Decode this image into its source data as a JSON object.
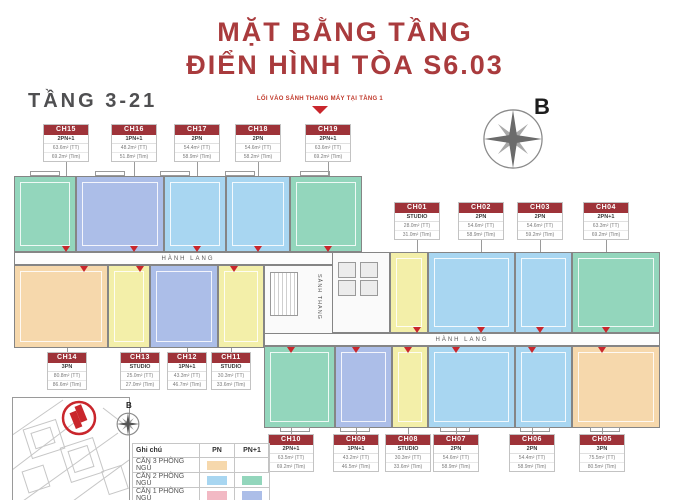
{
  "header": {
    "title_line1": "MẶT BẰNG TẦNG",
    "title_line2": "ĐIỂN HÌNH TÒA S6.03",
    "floor_range": "TẦNG 3-21",
    "entry_note": "LỐI VÀO SẢNH THANG MÁY TẠI TẦNG 1",
    "compass_label": "B"
  },
  "plan": {
    "corridor_left_label": "HÀNH LANG",
    "corridor_right_label": "HÀNH LANG",
    "stair_lobby_label": "SẢNH THANG"
  },
  "units": [
    {
      "id": "CH15",
      "type": "2PN+1",
      "area_tt": "63.6m² (TT)",
      "area_tim": "69.2m² (Tim)",
      "color": "#93D6BC"
    },
    {
      "id": "CH16",
      "type": "1PN+1",
      "area_tt": "48.2m² (TT)",
      "area_tim": "51.8m² (Tim)",
      "color": "#ACBEE8"
    },
    {
      "id": "CH17",
      "type": "2PN",
      "area_tt": "54.4m² (TT)",
      "area_tim": "58.9m² (Tim)",
      "color": "#A8D6F1"
    },
    {
      "id": "CH18",
      "type": "2PN",
      "area_tt": "54.6m² (TT)",
      "area_tim": "58.2m² (Tim)",
      "color": "#A8D6F1"
    },
    {
      "id": "CH19",
      "type": "2PN+1",
      "area_tt": "63.6m² (TT)",
      "area_tim": "69.2m² (Tim)",
      "color": "#93D6BC"
    },
    {
      "id": "CH01",
      "type": "STUDIO",
      "area_tt": "28.0m² (TT)",
      "area_tim": "31.0m² (Tim)",
      "color": "#F3EFA9"
    },
    {
      "id": "CH02",
      "type": "2PN",
      "area_tt": "54.6m² (TT)",
      "area_tim": "58.9m² (Tim)",
      "color": "#A8D6F1"
    },
    {
      "id": "CH03",
      "type": "2PN",
      "area_tt": "54.6m² (TT)",
      "area_tim": "59.2m² (Tim)",
      "color": "#A8D6F1"
    },
    {
      "id": "CH04",
      "type": "2PN+1",
      "area_tt": "63.3m² (TT)",
      "area_tim": "69.2m² (Tim)",
      "color": "#93D6BC"
    },
    {
      "id": "CH14",
      "type": "3PN",
      "area_tt": "80.8m² (TT)",
      "area_tim": "86.6m² (Tim)",
      "color": "#F6D8AC"
    },
    {
      "id": "CH13",
      "type": "STUDIO",
      "area_tt": "25.0m² (TT)",
      "area_tim": "27.0m² (Tim)",
      "color": "#F3EFA9"
    },
    {
      "id": "CH12",
      "type": "1PN+1",
      "area_tt": "43.3m² (TT)",
      "area_tim": "46.7m² (Tim)",
      "color": "#ACBEE8"
    },
    {
      "id": "CH11",
      "type": "STUDIO",
      "area_tt": "30.3m² (TT)",
      "area_tim": "33.6m² (Tim)",
      "color": "#F3EFA9"
    },
    {
      "id": "CH10",
      "type": "2PN+1",
      "area_tt": "63.5m² (TT)",
      "area_tim": "69.2m² (Tim)",
      "color": "#93D6BC"
    },
    {
      "id": "CH09",
      "type": "1PN+1",
      "area_tt": "43.2m² (TT)",
      "area_tim": "46.5m² (Tim)",
      "color": "#ACBEE8"
    },
    {
      "id": "CH08",
      "type": "STUDIO",
      "area_tt": "30.3m² (TT)",
      "area_tim": "33.6m² (Tim)",
      "color": "#F3EFA9"
    },
    {
      "id": "CH07",
      "type": "2PN",
      "area_tt": "54.6m² (TT)",
      "area_tim": "58.9m² (Tim)",
      "color": "#A8D6F1"
    },
    {
      "id": "CH06",
      "type": "2PN",
      "area_tt": "54.4m² (TT)",
      "area_tim": "58.9m² (Tim)",
      "color": "#A8D6F1"
    },
    {
      "id": "CH05",
      "type": "3PN",
      "area_tt": "75.5m² (TT)",
      "area_tim": "80.5m² (Tim)",
      "color": "#F6D8AC"
    }
  ],
  "legend": {
    "title": "Ghi chú",
    "col_pn": "PN",
    "col_pn1": "PN+1",
    "rows": [
      {
        "label": "CĂN 3 PHÒNG NGỦ",
        "pn": "#F6D8AC",
        "pn1": ""
      },
      {
        "label": "CĂN 2 PHÒNG NGỦ",
        "pn": "#A8D6F1",
        "pn1": "#93D6BC"
      },
      {
        "label": "CĂN 1 PHÒNG NGỦ",
        "pn": "#F2B9C4",
        "pn1": "#ACBEE8"
      }
    ]
  },
  "inset": {
    "compass_label": "B"
  },
  "accent": {
    "brand_red": "#A93B3D",
    "marker_red": "#C9262C",
    "label_red": "#9E3339"
  }
}
